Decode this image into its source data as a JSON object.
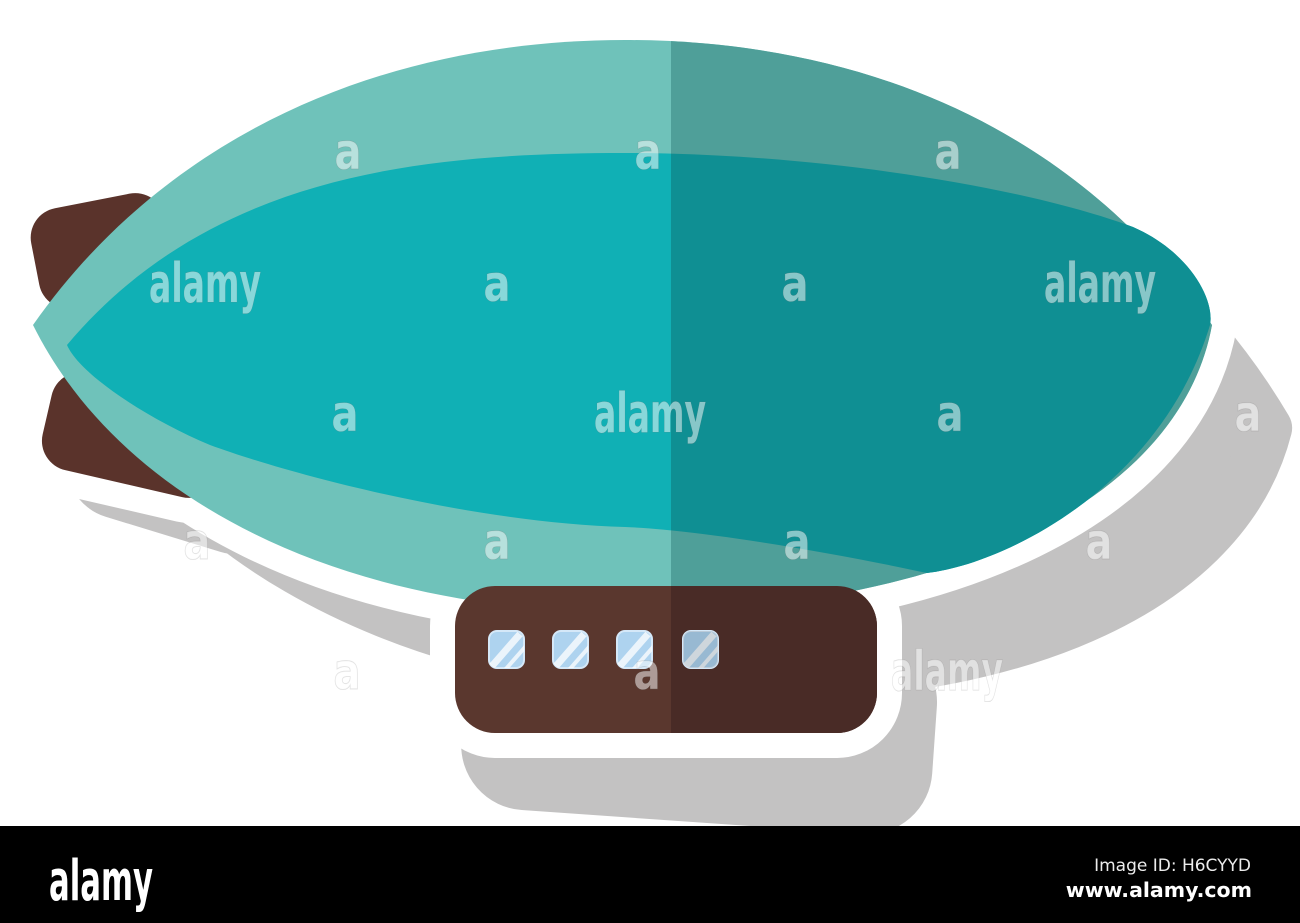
{
  "illustration": {
    "subject": "flat airship zeppelin sticker icon",
    "style": "flat vector sticker with white outline and grey drop shadow",
    "cabin_window_count": 4,
    "colors": {
      "background": "#ffffff",
      "balloon_outer_left": "#6fc2ba",
      "balloon_outer_right": "#4f9f99",
      "balloon_inner_left": "#10b0b5",
      "balloon_inner_right": "#0f8f93",
      "tail_fin_brown": "#5a332b",
      "cabin_left": "#5a372e",
      "cabin_right": "#492b26",
      "window_blue": "#aed3ef",
      "sticker_outline": "#ffffff",
      "drop_shadow": "#c3c2c2"
    }
  },
  "watermarks": {
    "items": [
      {
        "text": "a",
        "x": 348,
        "y": 155
      },
      {
        "text": "a",
        "x": 648,
        "y": 155
      },
      {
        "text": "a",
        "x": 948,
        "y": 155
      },
      {
        "text": "alamy",
        "x": 205,
        "y": 287
      },
      {
        "text": "a",
        "x": 497,
        "y": 287
      },
      {
        "text": "a",
        "x": 795,
        "y": 287
      },
      {
        "text": "alamy",
        "x": 1100,
        "y": 287
      },
      {
        "text": "a",
        "x": 345,
        "y": 417
      },
      {
        "text": "alamy",
        "x": 650,
        "y": 417
      },
      {
        "text": "a",
        "x": 950,
        "y": 417
      },
      {
        "text": "a",
        "x": 1248,
        "y": 417
      },
      {
        "text": "a",
        "x": 197,
        "y": 545
      },
      {
        "text": "a",
        "x": 497,
        "y": 545
      },
      {
        "text": "a",
        "x": 797,
        "y": 545
      },
      {
        "text": "a",
        "x": 1099,
        "y": 545
      },
      {
        "text": "a",
        "x": 347,
        "y": 675
      },
      {
        "text": "a",
        "x": 647,
        "y": 675
      },
      {
        "text": "alamy",
        "x": 947,
        "y": 675
      }
    ]
  },
  "footer": {
    "background": "#000000",
    "logo": "alamy",
    "image_id": "Image ID: H6CYYD",
    "website": "www.alamy.com"
  }
}
